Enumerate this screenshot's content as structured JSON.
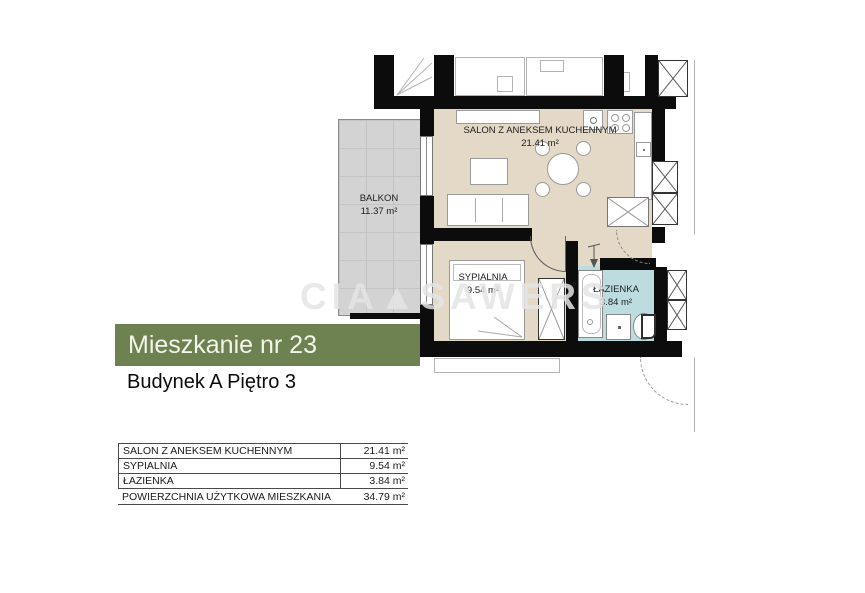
{
  "banner": {
    "label": "Mieszkanie nr 23",
    "bg_color": "#6e8150",
    "text_color": "#f2f5ea"
  },
  "subtitle": {
    "label": "Budynek A Piętro 3"
  },
  "watermark": {
    "text": "CIA▲SAWERS"
  },
  "floor_plan": {
    "wall_color": "#0c0c0c",
    "rooms": [
      {
        "name": "SALON Z ANEKSEM KUCHENNYM",
        "area": "21.41 m²",
        "fill": "#e4d9c6"
      },
      {
        "name": "BALKON",
        "area": "11.37 m²",
        "fill": "#d3d3d3"
      },
      {
        "name": "SYPIALNIA",
        "area": "9.54 m²",
        "fill": "#e4d9c6"
      },
      {
        "name": "ŁAZIENKA",
        "area": "3.84 m²",
        "fill": "#bcdce0"
      }
    ]
  },
  "area_table": {
    "rows": [
      {
        "label": "SALON Z ANEKSEM KUCHENNYM",
        "value": "21.41 m²"
      },
      {
        "label": "SYPIALNIA",
        "value": "9.54 m²"
      },
      {
        "label": "ŁAZIENKA",
        "value": "3.84 m²"
      }
    ],
    "total_label": "POWIERZCHNIA UŻYTKOWA MIESZKANIA",
    "total_value": "34.79 m²"
  }
}
